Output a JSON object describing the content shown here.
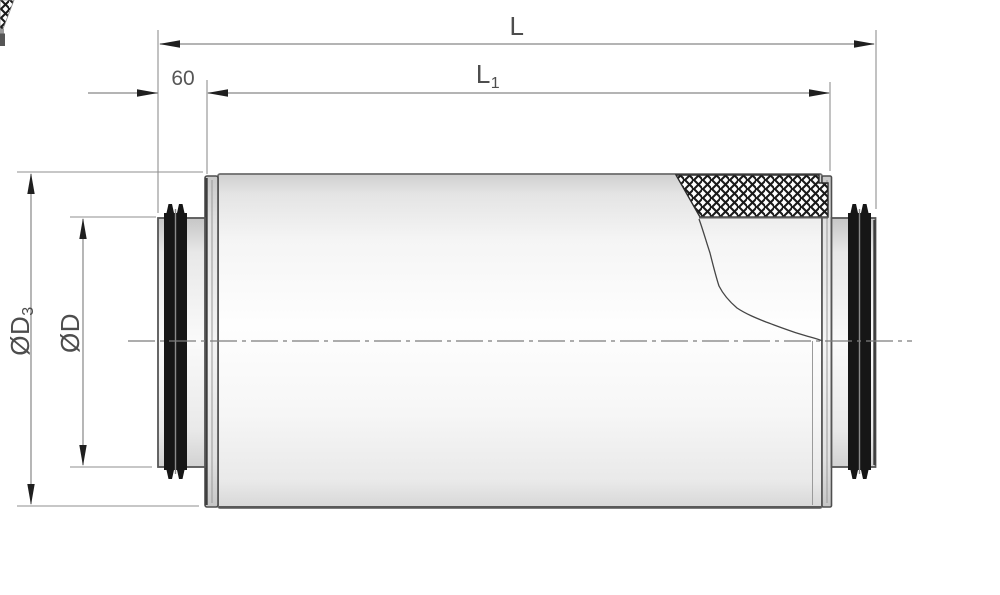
{
  "drawing": {
    "dim_overall_length": "L",
    "dim_inner_length_main": "L",
    "dim_inner_length_sub": "1",
    "dim_spigot_depth": "60",
    "dim_outer_diameter_main": "ØD",
    "dim_outer_diameter_sub": "3",
    "dim_spigot_diameter": "ØD"
  },
  "colors": {
    "background": "#ffffff",
    "outline": "#5f5f5f",
    "dim_line": "#8f8f8f",
    "arrow": "#1f1f1f",
    "label_text": "#4d4d4d",
    "rib_dark": "#161616",
    "hatch": "#1a1a1a",
    "body_fill_light": "#fcfcfc",
    "body_fill_dark": "#d9d9d9"
  }
}
